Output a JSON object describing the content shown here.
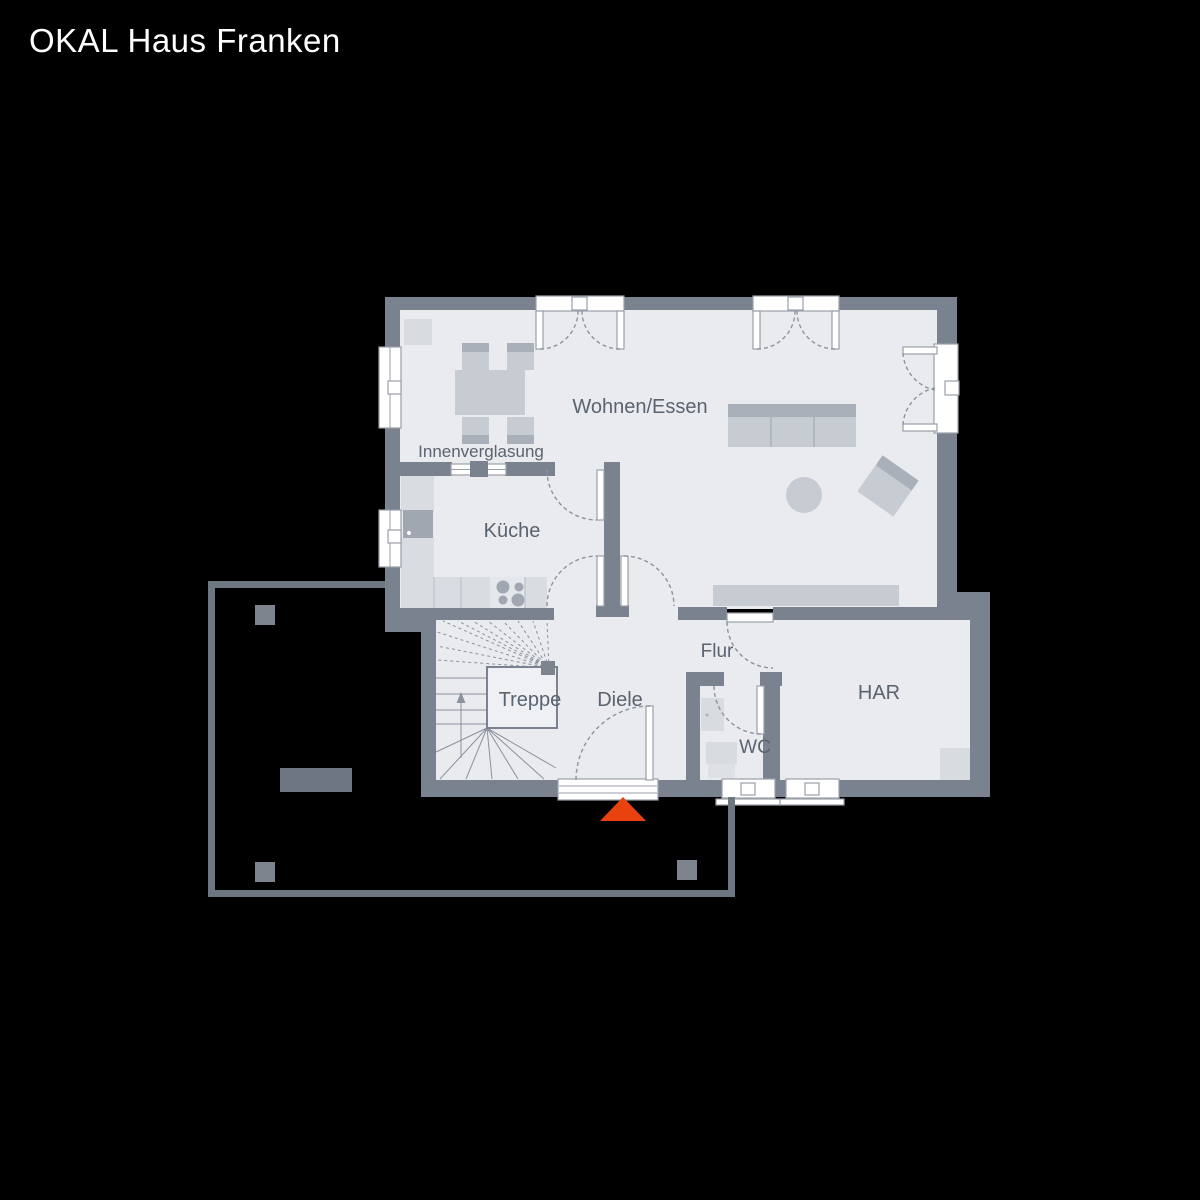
{
  "header": {
    "title": "OKAL Haus Franken"
  },
  "floorplan": {
    "labels": {
      "living": "Wohnen/Essen",
      "glazing": "Innenverglasung",
      "kitchen": "Küche",
      "stairs": "Treppe",
      "hallway": "Diele",
      "corridor": "Flur",
      "wc": "WC",
      "har": "HAR"
    }
  },
  "colors": {
    "background": "#000000",
    "title-text": "#ffffff",
    "wall": "#79828e",
    "floor": "#e9ebee",
    "furniture": "#c7ccd3",
    "furniture-dark": "#a9b0b9",
    "counter": "#d9dce1",
    "appliance": "#a0a7b0",
    "equipment": "#d8dbdf",
    "frame": "#9aa0a9",
    "arc": "#8b94a0",
    "stair-line": "#8a929d",
    "landing": "#eef0f3",
    "text": "#5a6370",
    "accent": "#e8430e",
    "terrace": "#6e7681",
    "post": "#7d848e"
  }
}
